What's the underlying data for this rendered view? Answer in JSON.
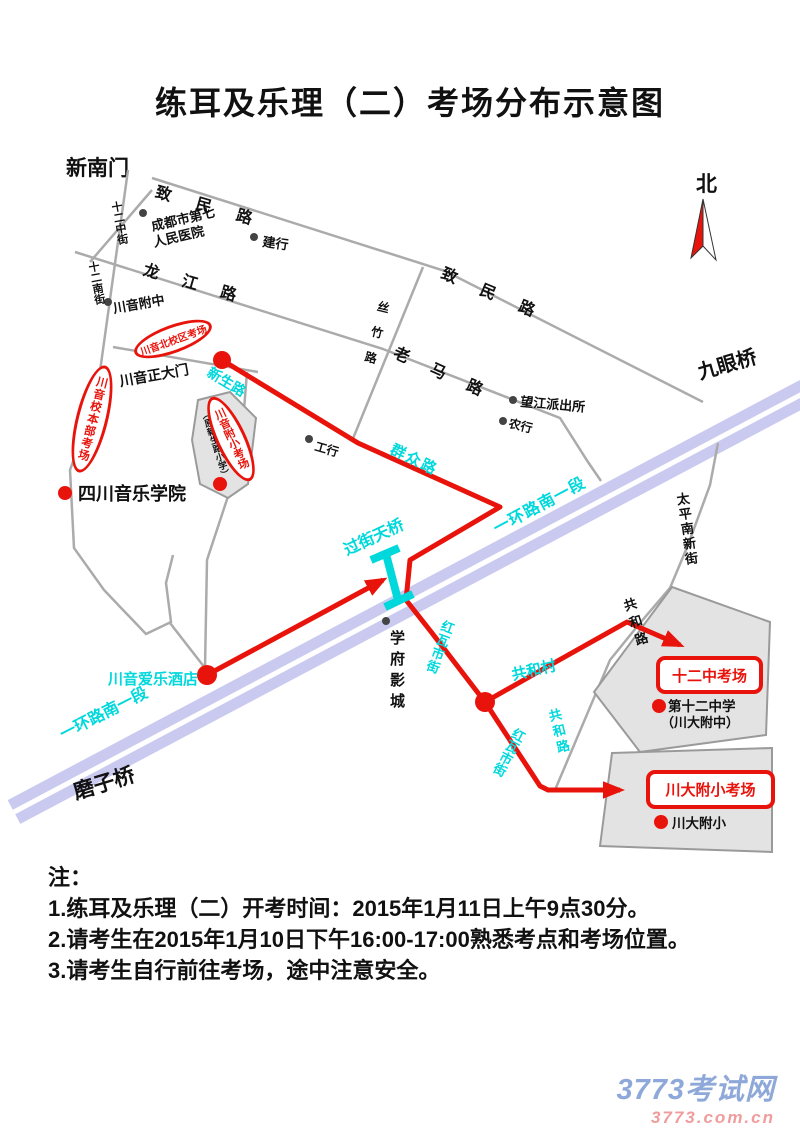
{
  "title": "练耳及乐理（二）考场分布示意图",
  "compass": {
    "north": "北"
  },
  "landmarks": {
    "xinnanmen": "新南门",
    "mozhiqiao": "磨子桥",
    "jiuyanqiao": "九眼桥"
  },
  "roads": {
    "zhimin": "致民路",
    "longjiang": "龙江路",
    "sizhu": "丝竹路",
    "laoma": "老马路",
    "shierzhong_st": "十二中街",
    "shiernan_st": "十二南街",
    "taipingnanxin_st": "太平南新街",
    "gonghe_rd": "共和路",
    "xinsheng": "新生路",
    "qunzhong": "群众路",
    "yihuan": "一环路南一段",
    "hongwashi_st": "红瓦市街",
    "gonghe_village": "共和村",
    "footbridge": "过街天桥"
  },
  "pois": {
    "hospital_line1": "成都市第七",
    "hospital_line2": "人民医院",
    "ccb": "建行",
    "icbc": "工行",
    "abc": "农行",
    "cy_fuzhong": "川音附中",
    "police": "望江派出所",
    "conservatory": "四川音乐学院",
    "main_gate": "川音正大门",
    "cinema": "学府影城",
    "hotel": "川音爱乐酒店",
    "fuxiao_school": "川音附小",
    "fuxiao_school_alias": "（原新生路小学）",
    "no12_school": "第十二中学",
    "no12_school_alias": "（川大附中）",
    "cd_fuxiao": "川大附小"
  },
  "venues": {
    "north_campus": "川音北校区考场",
    "main_campus": "川音校本部考场",
    "cy_fuxiao": "川音附小考场",
    "no12": "十二中考场",
    "cd_fuxiao": "川大附小考场"
  },
  "notes": {
    "heading": "注：",
    "items": [
      "1.练耳及乐理（二）开考时间：2015年1月11日上午9点30分。",
      "2.请考生在2015年1月10日下午16:00-17:00熟悉考点和考场位置。",
      "3.请考生自行前往考场，途中注意安全。"
    ]
  },
  "watermark": {
    "site": "3773考试网",
    "domain": "3773.com.cn"
  },
  "colors": {
    "route_red": "#e8140c",
    "road_gray": "#ababab",
    "ring_road": "#cacaf0",
    "label_cyan": "#00d8dc",
    "building_fill": "#e3e3e3",
    "watermark_blue": "#8ea9d9",
    "watermark_pink": "#f09c9c"
  }
}
